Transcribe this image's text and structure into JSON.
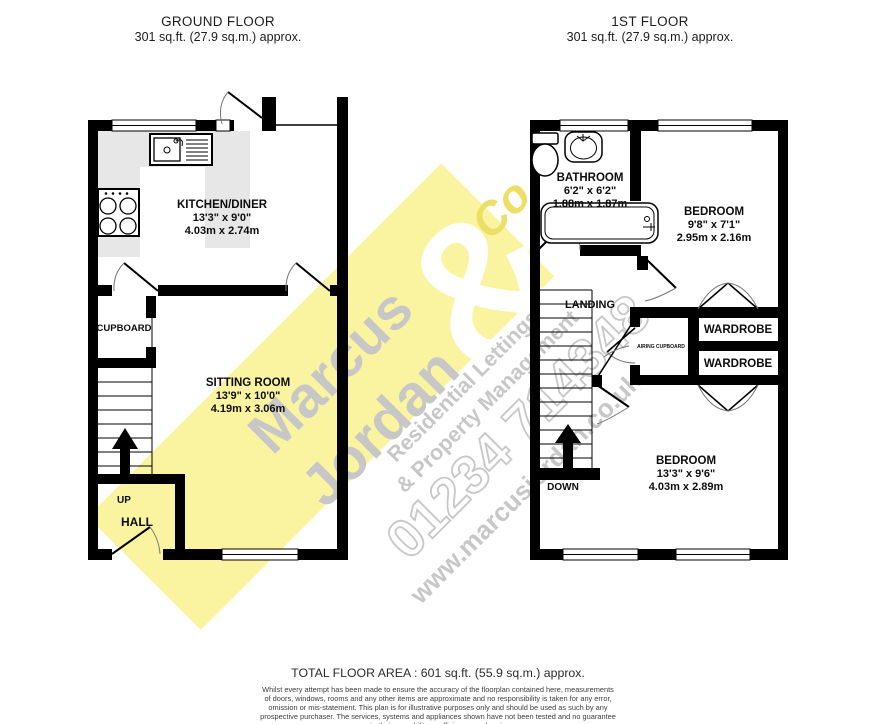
{
  "header": {
    "ground_floor": {
      "title": "GROUND FLOOR",
      "area": "301 sq.ft. (27.9 sq.m.) approx."
    },
    "first_floor": {
      "title": "1ST FLOOR",
      "area": "301 sq.ft. (27.9 sq.m.) approx."
    }
  },
  "ground_floor": {
    "kitchen": {
      "name": "KITCHEN/DINER",
      "imperial": "13'3\" x 9'0\"",
      "metric": "4.03m x 2.74m"
    },
    "sitting": {
      "name": "SITTING ROOM",
      "imperial": "13'9\" x 10'0\"",
      "metric": "4.19m x 3.06m"
    },
    "cupboard": "CUPBOARD",
    "hall": "HALL",
    "up": "UP"
  },
  "first_floor": {
    "bathroom": {
      "name": "BATHROOM",
      "imperial": "6'2\" x 6'2\"",
      "metric": "1.88m x 1.87m"
    },
    "bedroom1": {
      "name": "BEDROOM",
      "imperial": "9'8\" x 7'1\"",
      "metric": "2.95m x 2.16m"
    },
    "bedroom2": {
      "name": "BEDROOM",
      "imperial": "13'3\" x 9'6\"",
      "metric": "4.03m x 2.89m"
    },
    "landing": "LANDING",
    "wardrobe1": "WARDROBE",
    "wardrobe2": "WARDROBE",
    "airing_cupboard": "AIRING CUPBOARD",
    "down": "DOWN"
  },
  "watermark": {
    "brand_line1": "Marcus",
    "brand_line2": "Jordan",
    "ampersand": "&",
    "co": "Co",
    "tagline1": "Residential Lettings",
    "tagline2": "& Property Management",
    "phone": "01234 714348",
    "website": "www.marcusjordan.co.uk"
  },
  "footer": {
    "total": "TOTAL FLOOR AREA : 601 sq.ft. (55.9 sq.m.) approx.",
    "disclaimer_lines": [
      "Whilst every attempt has been made to ensure the accuracy of the floorplan contained here, measurements",
      "of doors, windows, rooms and any other items are approximate and no responsibility is taken for any error,",
      "omission or mis-statement. This plan is for illustrative purposes only and should be used as such by any",
      "prospective purchaser. The services, systems and appliances shown have not been tested and no guarantee",
      "as to their operability or efficiency can be given."
    ],
    "credit": "Made with Metropix ©2022"
  },
  "colors": {
    "wall": "#000000",
    "counter": "#e7e7e7",
    "watermark_band": "#FAF4A1",
    "watermark_text": "#c7c7c7",
    "co_text": "#EDDF66"
  }
}
